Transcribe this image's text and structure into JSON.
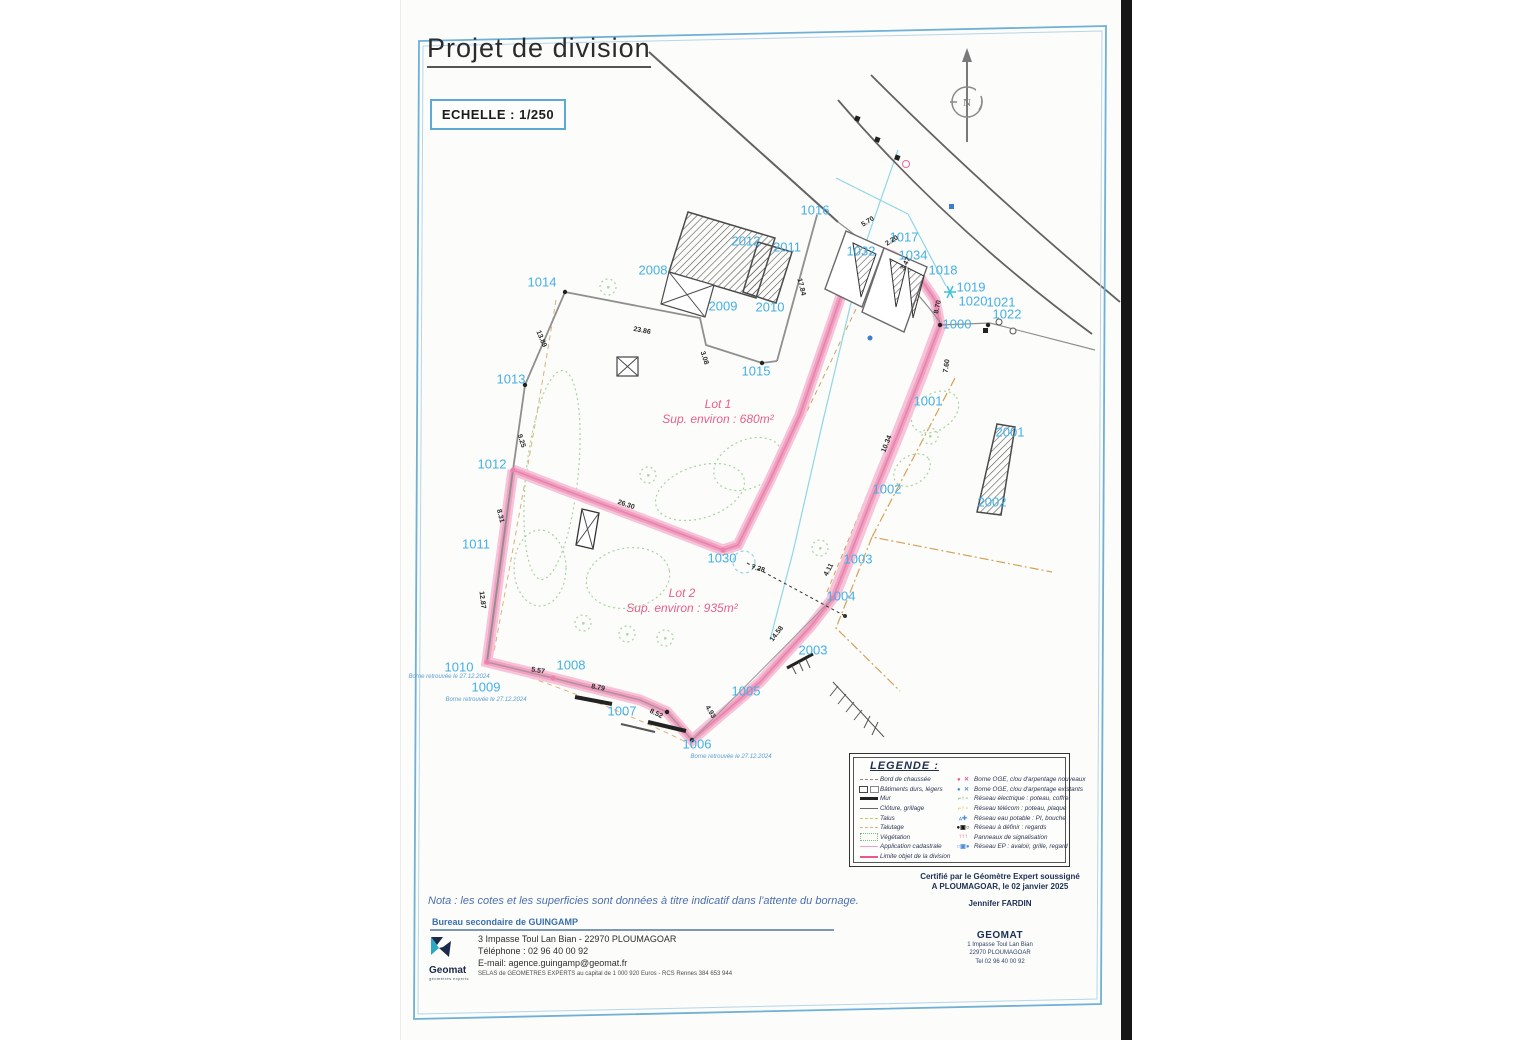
{
  "page": {
    "title": "Projet de division",
    "scale_label": "ECHELLE : 1/250",
    "north_label": "N"
  },
  "plan": {
    "lots": [
      {
        "name": "Lot 1",
        "area": "Sup. environ : 680m²",
        "x": 718,
        "y": 412
      },
      {
        "name": "Lot 2",
        "area": "Sup. environ : 935m²",
        "x": 682,
        "y": 601
      }
    ],
    "parcel_labels": [
      {
        "t": "1000",
        "x": 957,
        "y": 324
      },
      {
        "t": "1001",
        "x": 928,
        "y": 401
      },
      {
        "t": "1002",
        "x": 887,
        "y": 489
      },
      {
        "t": "1003",
        "x": 858,
        "y": 559
      },
      {
        "t": "1004",
        "x": 841,
        "y": 596
      },
      {
        "t": "1005",
        "x": 746,
        "y": 691
      },
      {
        "t": "1006",
        "x": 697,
        "y": 744
      },
      {
        "t": "1007",
        "x": 622,
        "y": 711
      },
      {
        "t": "1008",
        "x": 571,
        "y": 665
      },
      {
        "t": "1009",
        "x": 486,
        "y": 687
      },
      {
        "t": "1010",
        "x": 459,
        "y": 667
      },
      {
        "t": "1011",
        "x": 476,
        "y": 544
      },
      {
        "t": "1012",
        "x": 492,
        "y": 464
      },
      {
        "t": "1013",
        "x": 511,
        "y": 379
      },
      {
        "t": "1014",
        "x": 542,
        "y": 282
      },
      {
        "t": "1015",
        "x": 756,
        "y": 371
      },
      {
        "t": "1016",
        "x": 815,
        "y": 210
      },
      {
        "t": "1017",
        "x": 904,
        "y": 237
      },
      {
        "t": "1018",
        "x": 943,
        "y": 270
      },
      {
        "t": "1019",
        "x": 971,
        "y": 287
      },
      {
        "t": "1020",
        "x": 973,
        "y": 301
      },
      {
        "t": "1021",
        "x": 1001,
        "y": 302
      },
      {
        "t": "1022",
        "x": 1007,
        "y": 314
      },
      {
        "t": "1030",
        "x": 722,
        "y": 558
      },
      {
        "t": "1032",
        "x": 861,
        "y": 251
      },
      {
        "t": "1034",
        "x": 913,
        "y": 255
      },
      {
        "t": "2001",
        "x": 1010,
        "y": 432
      },
      {
        "t": "2002",
        "x": 992,
        "y": 502
      },
      {
        "t": "2003",
        "x": 813,
        "y": 650
      },
      {
        "t": "2008",
        "x": 653,
        "y": 270
      },
      {
        "t": "2009",
        "x": 723,
        "y": 306
      },
      {
        "t": "2010",
        "x": 770,
        "y": 307
      },
      {
        "t": "2011",
        "x": 787,
        "y": 247
      },
      {
        "t": "2012",
        "x": 746,
        "y": 241
      }
    ],
    "measurements": [
      {
        "t": "5.70",
        "x": 868,
        "y": 222,
        "r": -32
      },
      {
        "t": "2.20",
        "x": 892,
        "y": 241,
        "r": -32
      },
      {
        "t": "3.47",
        "x": 906,
        "y": 264,
        "r": -62
      },
      {
        "t": "8.70",
        "x": 938,
        "y": 307,
        "r": -78
      },
      {
        "t": "17.84",
        "x": 801,
        "y": 287,
        "r": 76
      },
      {
        "t": "23.86",
        "x": 642,
        "y": 331,
        "r": 11
      },
      {
        "t": "3.08",
        "x": 704,
        "y": 358,
        "r": 72
      },
      {
        "t": "13.89",
        "x": 541,
        "y": 339,
        "r": 67
      },
      {
        "t": "9.25",
        "x": 521,
        "y": 441,
        "r": 72
      },
      {
        "t": "8.31",
        "x": 500,
        "y": 516,
        "r": 76
      },
      {
        "t": "12.87",
        "x": 482,
        "y": 600,
        "r": 83
      },
      {
        "t": "5.57",
        "x": 538,
        "y": 671,
        "r": 9
      },
      {
        "t": "8.79",
        "x": 598,
        "y": 688,
        "r": 11
      },
      {
        "t": "8.52",
        "x": 656,
        "y": 714,
        "r": 26
      },
      {
        "t": "4.93",
        "x": 710,
        "y": 712,
        "r": 60
      },
      {
        "t": "26.30",
        "x": 626,
        "y": 505,
        "r": 19
      },
      {
        "t": "7.28",
        "x": 758,
        "y": 569,
        "r": 17
      },
      {
        "t": "4.11",
        "x": 829,
        "y": 570,
        "r": -62
      },
      {
        "t": "14.58",
        "x": 777,
        "y": 634,
        "r": -52
      },
      {
        "t": "10.34",
        "x": 887,
        "y": 444,
        "r": -68
      },
      {
        "t": "7.60",
        "x": 947,
        "y": 366,
        "r": -82
      }
    ],
    "notes": [
      {
        "t": "Borne retrouvée le 27.12.2024",
        "x": 449,
        "y": 677
      },
      {
        "t": "Borne retrouvée le 27.12.2024",
        "x": 486,
        "y": 700
      },
      {
        "t": "Borne retrouvée le 27.12.2024",
        "x": 731,
        "y": 757
      }
    ]
  },
  "legend": {
    "title": "LEGENDE :",
    "left": [
      {
        "sym": "road-edge",
        "label": "Bord de chaussée"
      },
      {
        "sym": "buildings",
        "label": "Bâtiments durs, légers"
      },
      {
        "sym": "wall",
        "label": "Mur"
      },
      {
        "sym": "fence",
        "label": "Clôture, grillage"
      },
      {
        "sym": "talus",
        "label": "Talus"
      },
      {
        "sym": "talutage",
        "label": "Talutage"
      },
      {
        "sym": "vegetation",
        "label": "Végétation"
      },
      {
        "sym": "cadastral",
        "label": "Application cadastrale"
      },
      {
        "sym": "division",
        "label": "Limite objet de la division"
      }
    ],
    "right": [
      {
        "sym": "borne-new",
        "label": "Borne OGE, clou d'arpentage nouveaux"
      },
      {
        "sym": "borne-old",
        "label": "Borne OGE, clou d'arpentage existants"
      },
      {
        "sym": "elec",
        "label": "Réseau électrique : poteau, coffret"
      },
      {
        "sym": "telecom",
        "label": "Réseau télécom : poteau, plaque"
      },
      {
        "sym": "eau",
        "label": "Réseau eau potable : PI, bouche"
      },
      {
        "sym": "regards",
        "label": "Réseau à définir : regards"
      },
      {
        "sym": "panneaux",
        "label": "Panneaux de signalisation"
      },
      {
        "sym": "ep",
        "label": "Réseau EP : avaloir, grille, regard"
      }
    ]
  },
  "certification": {
    "line1": "Certifié par le Géomètre Expert soussigné",
    "line2": "A PLOUMAGOAR, le 02 janvier 2025",
    "signer": "Jennifer FARDIN",
    "company": "GEOMAT",
    "addr1": "1 Impasse Toul Lan Bian",
    "addr2": "22970 PLOUMAGOAR",
    "addr3": "Tel 02 96 40 00 92"
  },
  "footer": {
    "nota": "Nota : les cotes et les superficies sont données à titre indicatif dans l'attente du bornage.",
    "bureau": "Bureau secondaire de GUINGAMP",
    "logo_name": "Geomat",
    "logo_sub": "géomètres experts",
    "address": "3 Impasse Toul Lan Bian - 22970 PLOUMAGOAR",
    "phone": "Téléphone : 02 96 40 00 92",
    "email": "E-mail: agence.guingamp@geomat.fr",
    "legal": "SELAS de GEOMETRES EXPERTS au capital de 1 000 920 Euros - RCS Rennes 384 653 944"
  },
  "colors": {
    "parcel_label_blue": "#45b0e6",
    "division_pink": "#f0a0c0",
    "lot_text_pink": "#e7608a",
    "frame_blue": "#6fb0d6",
    "cadastral_tan": "#d4a158",
    "vegetation_green": "#a5d69e"
  }
}
